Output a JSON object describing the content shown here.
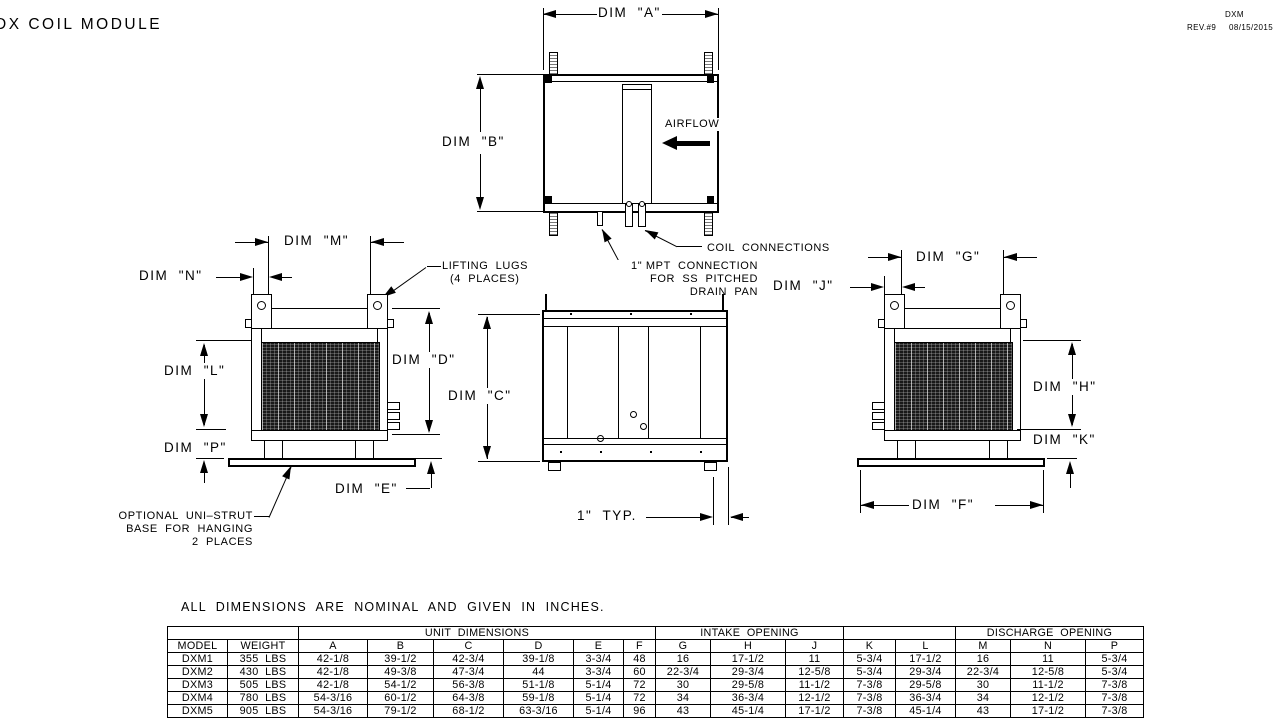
{
  "title": "DX COIL MODULE",
  "titleblock": {
    "code": "DXM",
    "rev": "REV.#9",
    "date": "08/15/2015"
  },
  "dims": {
    "a": "DIM  \"A\"",
    "b": "DIM  \"B\"",
    "c": "DIM  \"C\"",
    "d": "DIM  \"D\"",
    "e": "DIM  \"E\"",
    "f": "DIM  \"F\"",
    "g": "DIM  \"G\"",
    "h": "DIM  \"H\"",
    "j": "DIM  \"J\"",
    "k": "DIM  \"K\"",
    "l": "DIM  \"L\"",
    "m": "DIM  \"M\"",
    "n": "DIM  \"N\"",
    "p": "DIM  \"P\""
  },
  "annotations": {
    "airflow": "AIRFLOW",
    "coil_connections": "COIL  CONNECTIONS",
    "mpt_line1": "1\" MPT  CONNECTION",
    "mpt_line2": "FOR  SS  PITCHED",
    "mpt_line3": "DRAIN  PAN",
    "lifting_line1": "LIFTING  LUGS",
    "lifting_line2": "(4  PLACES)",
    "unistrut_line1": "OPTIONAL  UNI–STRUT",
    "unistrut_line2": "BASE  FOR  HANGING",
    "unistrut_line3": "2  PLACES",
    "typ_1in": "1\"  TYP.",
    "note": "ALL  DIMENSIONS  ARE  NOMINAL  AND  GIVEN  IN  INCHES."
  },
  "table": {
    "groups": [
      {
        "label": "",
        "span": 2
      },
      {
        "label": "UNIT  DIMENSIONS",
        "span": 6
      },
      {
        "label": "INTAKE  OPENING",
        "span": 3
      },
      {
        "label": "",
        "span": 2
      },
      {
        "label": "DISCHARGE  OPENING",
        "span": 3
      }
    ],
    "columns": [
      "MODEL",
      "WEIGHT",
      "A",
      "B",
      "C",
      "D",
      "E",
      "F",
      "G",
      "H",
      "J",
      "K",
      "L",
      "M",
      "N",
      "P"
    ],
    "rows": [
      [
        "DXM1",
        "355  LBS",
        "42-1/8",
        "39-1/2",
        "42-3/4",
        "39-1/8",
        "3-3/4",
        "48",
        "16",
        "17-1/2",
        "11",
        "5-3/4",
        "17-1/2",
        "16",
        "11",
        "5-3/4"
      ],
      [
        "DXM2",
        "430  LBS",
        "42-1/8",
        "49-3/8",
        "47-3/4",
        "44",
        "3-3/4",
        "60",
        "22-3/4",
        "29-3/4",
        "12-5/8",
        "5-3/4",
        "29-3/4",
        "22-3/4",
        "12-5/8",
        "5-3/4"
      ],
      [
        "DXM3",
        "505  LBS",
        "42-1/8",
        "54-1/2",
        "56-3/8",
        "51-1/8",
        "5-1/4",
        "72",
        "30",
        "29-5/8",
        "11-1/2",
        "7-3/8",
        "29-5/8",
        "30",
        "11-1/2",
        "7-3/8"
      ],
      [
        "DXM4",
        "780  LBS",
        "54-3/16",
        "60-1/2",
        "64-3/8",
        "59-1/8",
        "5-1/4",
        "72",
        "34",
        "36-3/4",
        "12-1/2",
        "7-3/8",
        "36-3/4",
        "34",
        "12-1/2",
        "7-3/8"
      ],
      [
        "DXM5",
        "905  LBS",
        "54-3/16",
        "79-1/2",
        "68-1/2",
        "63-3/16",
        "5-1/4",
        "96",
        "43",
        "45-1/4",
        "17-1/2",
        "7-3/8",
        "45-1/4",
        "43",
        "17-1/2",
        "7-3/8"
      ]
    ]
  }
}
